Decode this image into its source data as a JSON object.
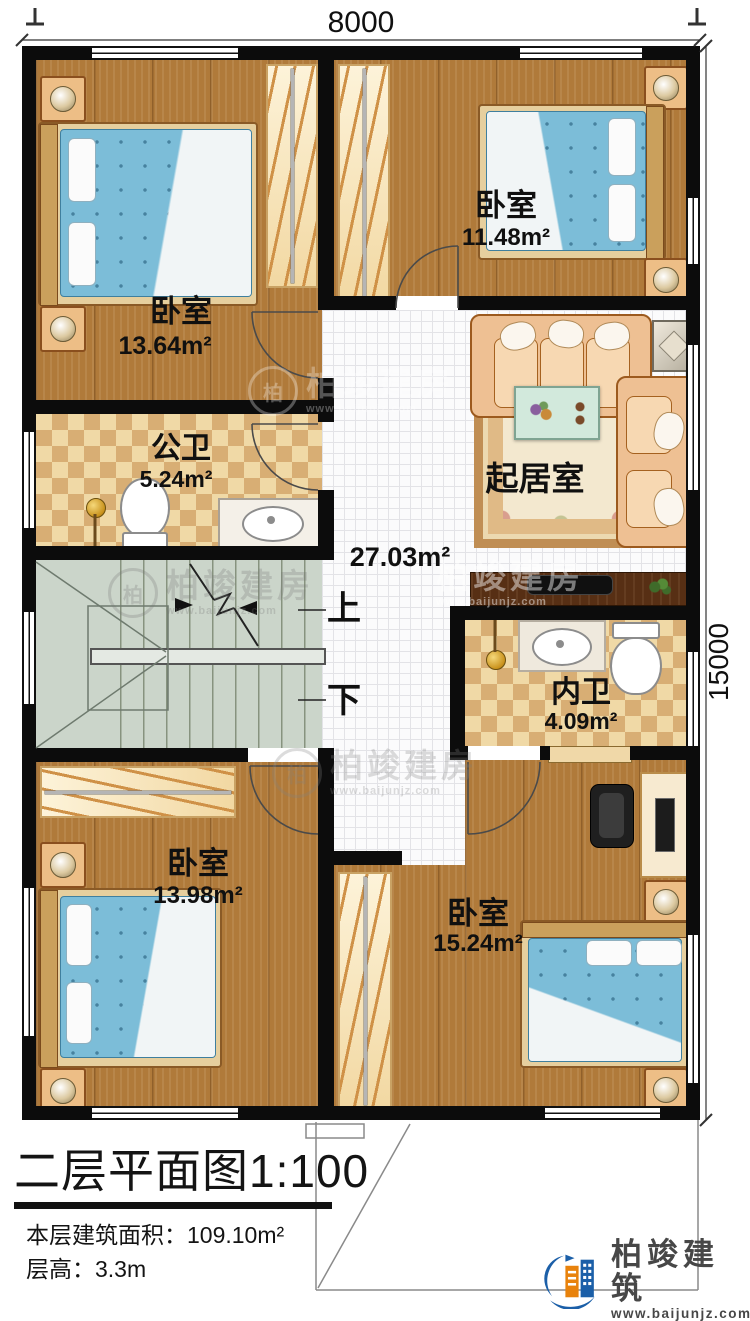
{
  "dimensions": {
    "width_top": "8000",
    "height_right": "15000"
  },
  "rooms": {
    "bedroom_tl": {
      "label": "卧室",
      "area": "13.64m²"
    },
    "bedroom_tr": {
      "label": "卧室",
      "area": "11.48m²"
    },
    "public_bath": {
      "label": "公卫",
      "area": "5.24m²"
    },
    "living": {
      "label": "起居室",
      "area": "27.03m²"
    },
    "ensuite_bath": {
      "label": "内卫",
      "area": "4.09m²"
    },
    "bedroom_bl": {
      "label": "卧室",
      "area": "13.98m²"
    },
    "bedroom_br": {
      "label": "卧室",
      "area": "15.24m²"
    }
  },
  "stairs": {
    "up_label": "上",
    "down_label": "下"
  },
  "title": {
    "text": "二层平面图",
    "scale": "1:100"
  },
  "info": {
    "area_label": "本层建筑面积：",
    "area_value": "109.10m²",
    "floor_height_label": "层高：",
    "floor_height_value": "3.3m"
  },
  "logo": {
    "name": "柏竣建筑",
    "website": "www.baijunjz.com"
  },
  "watermark": {
    "brand": "柏竣建房",
    "website": "www.baijunjz.com"
  }
}
